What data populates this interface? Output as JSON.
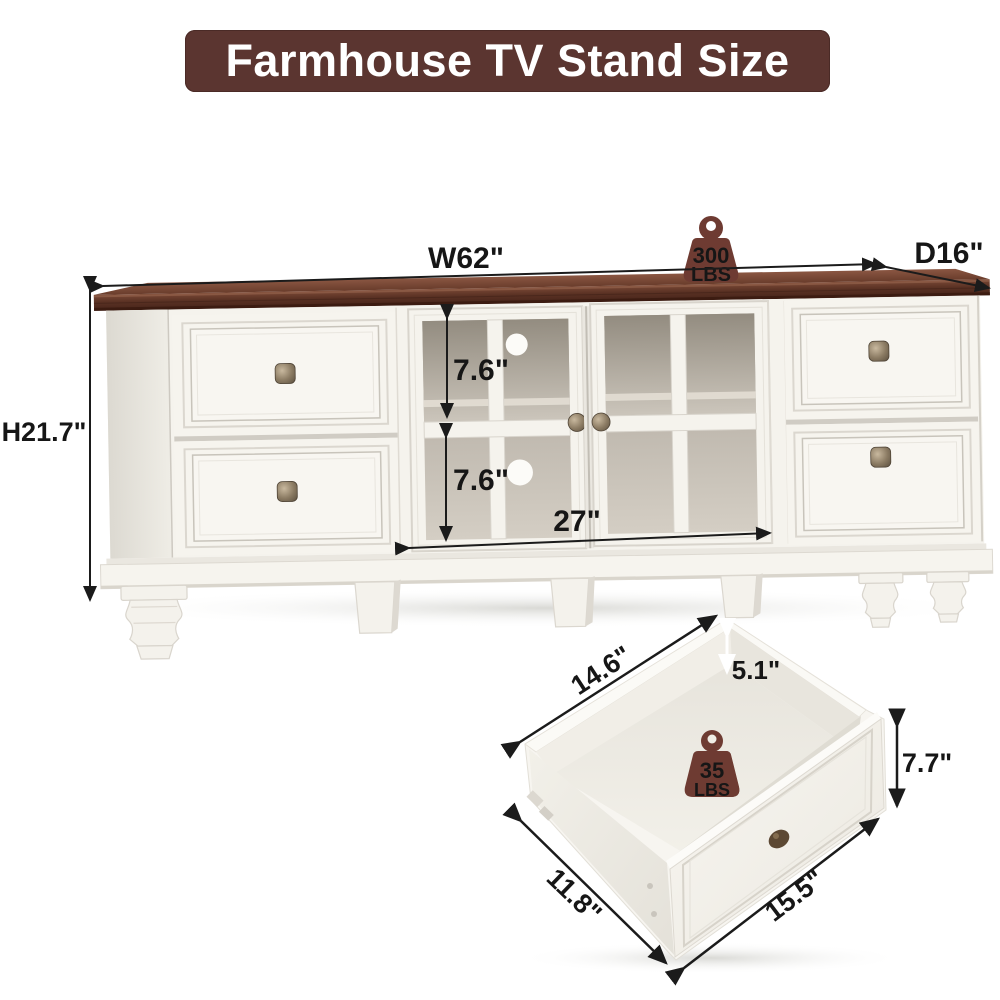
{
  "title": {
    "text": "Farmhouse TV Stand Size"
  },
  "colors": {
    "banner_bg": "#5b3530",
    "banner_text": "#ffffff",
    "wood_top": "#5b3224",
    "cabinet_body": "#f5f3ed",
    "glass": "#b5aea3",
    "knob": "#8a7a62",
    "dimension_line": "#1b1b1b",
    "weight_icon": "#6e3b32",
    "weight_icon_text": "#f3e8d6"
  },
  "tv_stand": {
    "weight_capacity": {
      "value": "300",
      "unit": "LBS"
    },
    "dims": {
      "width": "W62\"",
      "depth": "D16\"",
      "height": "H21.7\"",
      "upper_opening": "7.6\"",
      "lower_opening": "7.6\"",
      "center_section_width": "27\""
    }
  },
  "drawer": {
    "weight_capacity": {
      "value": "35",
      "unit": "LBS"
    },
    "dims": {
      "top_edge_depth": "14.6\"",
      "inner_height": "5.1\"",
      "front_height": "7.7\"",
      "side_depth": "11.8\"",
      "front_width": "15.5\""
    }
  }
}
